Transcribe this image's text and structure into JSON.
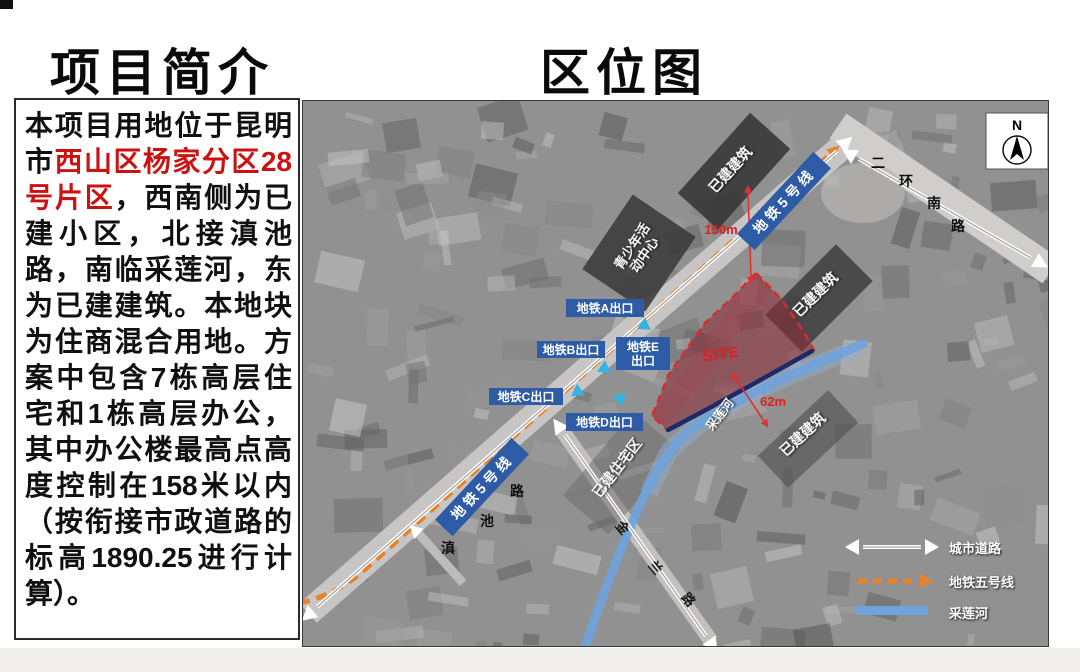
{
  "titles": {
    "left": "项目简介",
    "right": "区位图"
  },
  "intro": {
    "before": "本项目用地位于昆明市",
    "highlight": "西山区杨家分区28号片区",
    "after": "，西南侧为已建小区，北接滇池路，南临采莲河，东为已建建筑。本地块为住商混合用地。方案中包含7栋高层住宅和1栋高层办公，其中办公楼最高点高度控制在158米以内（按衔接市政道路的标高1890.25进行计算）。",
    "highlight_color": "#cc1111"
  },
  "map": {
    "compass": "N",
    "metro_banner": "地铁5号线",
    "exit_a": "地铁A出口",
    "exit_b": "地铁B出口",
    "exit_c": "地铁C出口",
    "exit_d": "地铁D出口",
    "exit_e_line1": "地铁E",
    "exit_e_line2": "出口",
    "site": "SITE",
    "river": "采莲河",
    "existing_building": "已建建筑",
    "existing_residential": "已建住宅区",
    "youth_center_line1": "青少年活",
    "youth_center_line2": "动中心",
    "dist_metro": "150m",
    "dist_river": "62m",
    "roads": {
      "dianchi_chars": [
        "滇",
        "池",
        "路"
      ],
      "erhuan_chars": [
        "二",
        "环",
        "南",
        "路"
      ],
      "jinlan_chars": [
        "金",
        "兰",
        "路"
      ]
    },
    "legend": {
      "road": "城市道路",
      "metro": "地铁五号线",
      "river": "采莲河"
    },
    "colors": {
      "metro_orange": "#e8822a",
      "label_blue": "#2d5ba6",
      "site_fill": "#8c2d37",
      "site_border": "#d92b2b",
      "river_blue": "#6fa3dc",
      "exit_cyan": "#35b3e3",
      "highlight_red": "#cc1111"
    }
  }
}
